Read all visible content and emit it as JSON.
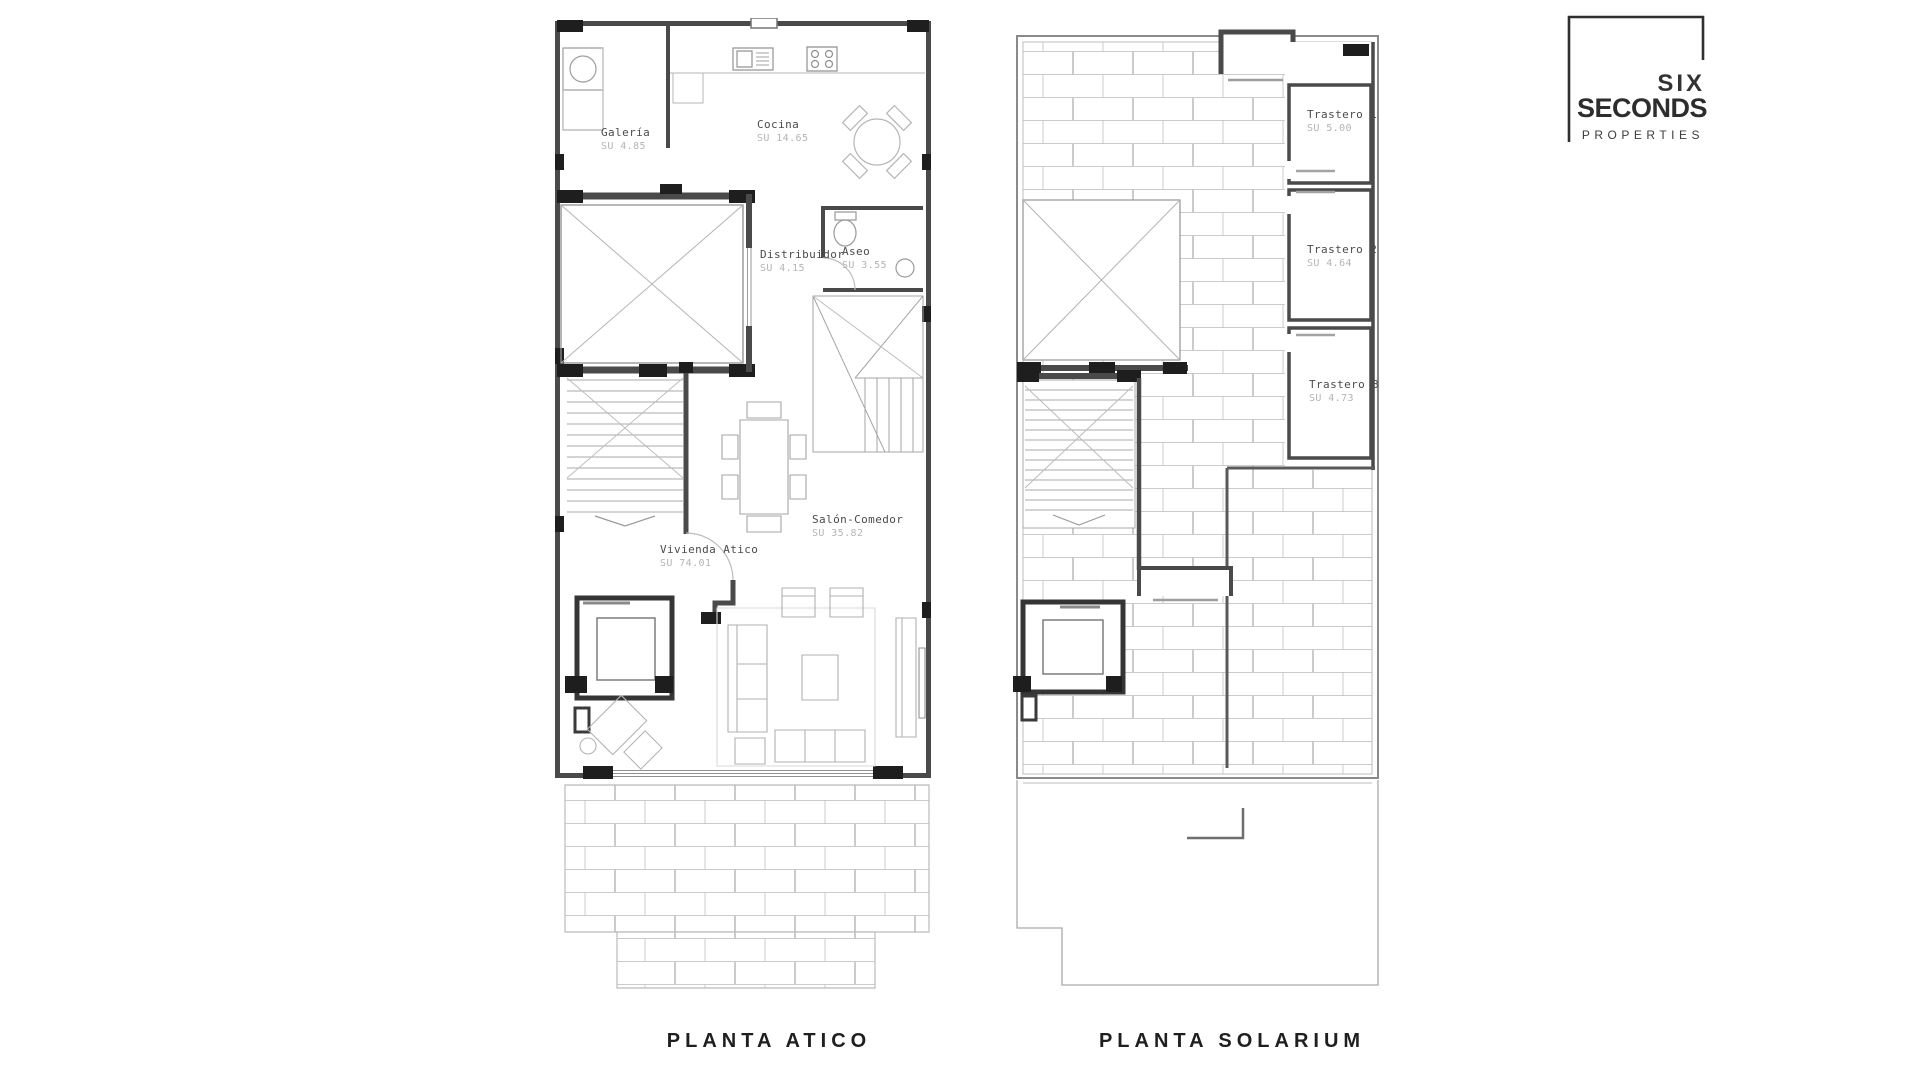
{
  "brand": {
    "line1": "SIX",
    "line2": "SECONDS",
    "line3": "PROPERTIES"
  },
  "plans": [
    {
      "title": "PLANTA ATICO",
      "rooms": [
        {
          "name": "Galería",
          "area": "SU 4.85"
        },
        {
          "name": "Cocina",
          "area": "SU 14.65"
        },
        {
          "name": "Distribuidor",
          "area": "SU 4.15"
        },
        {
          "name": "Aseo",
          "area": "SU 3.55"
        },
        {
          "name": "Salón-Comedor",
          "area": "SU 35.82"
        },
        {
          "name": "Vivienda Atico",
          "area": "SU 74.01"
        }
      ]
    },
    {
      "title": "PLANTA SOLARIUM",
      "rooms": [
        {
          "name": "Trastero 1",
          "area": "SU 5.00"
        },
        {
          "name": "Trastero 2",
          "area": "SU 4.64"
        },
        {
          "name": "Trastero 3",
          "area": "SU 4.73"
        }
      ]
    }
  ]
}
